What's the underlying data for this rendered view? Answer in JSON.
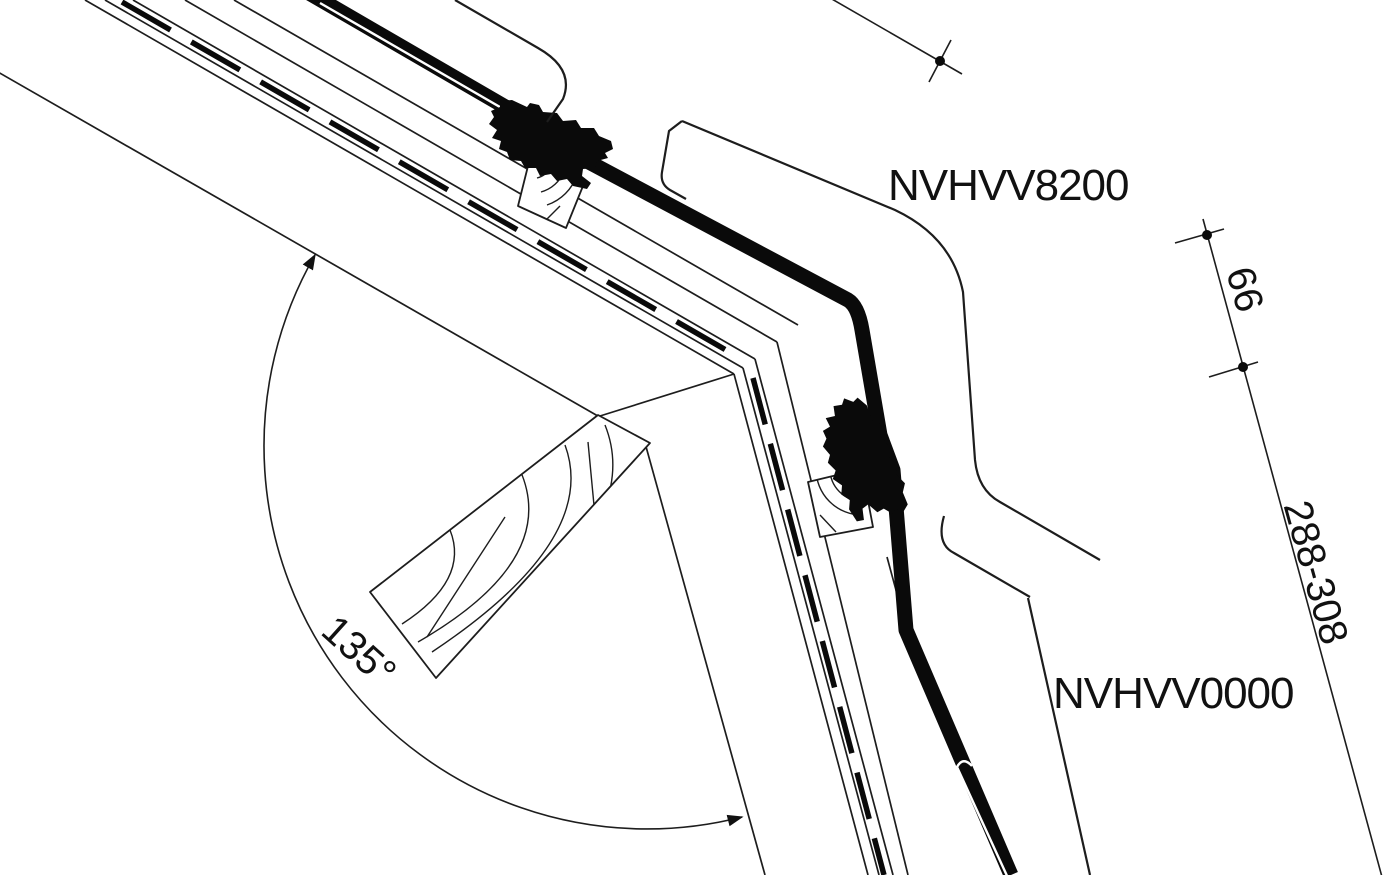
{
  "drawing": {
    "type": "technical-section-detail",
    "description": "Roof window combination flashing cross-section at 135 degree ridge",
    "colors": {
      "ink": "#1d1d1d",
      "background": "#ffffff",
      "flashing": "#0a0a0a"
    },
    "labels": {
      "upper_flashing": "NVHVV8200",
      "lower_flashing": "NVHVV0000"
    },
    "dimensions": {
      "angle": "135°",
      "upper_offset": "66",
      "flashing_range": "288-308"
    }
  }
}
